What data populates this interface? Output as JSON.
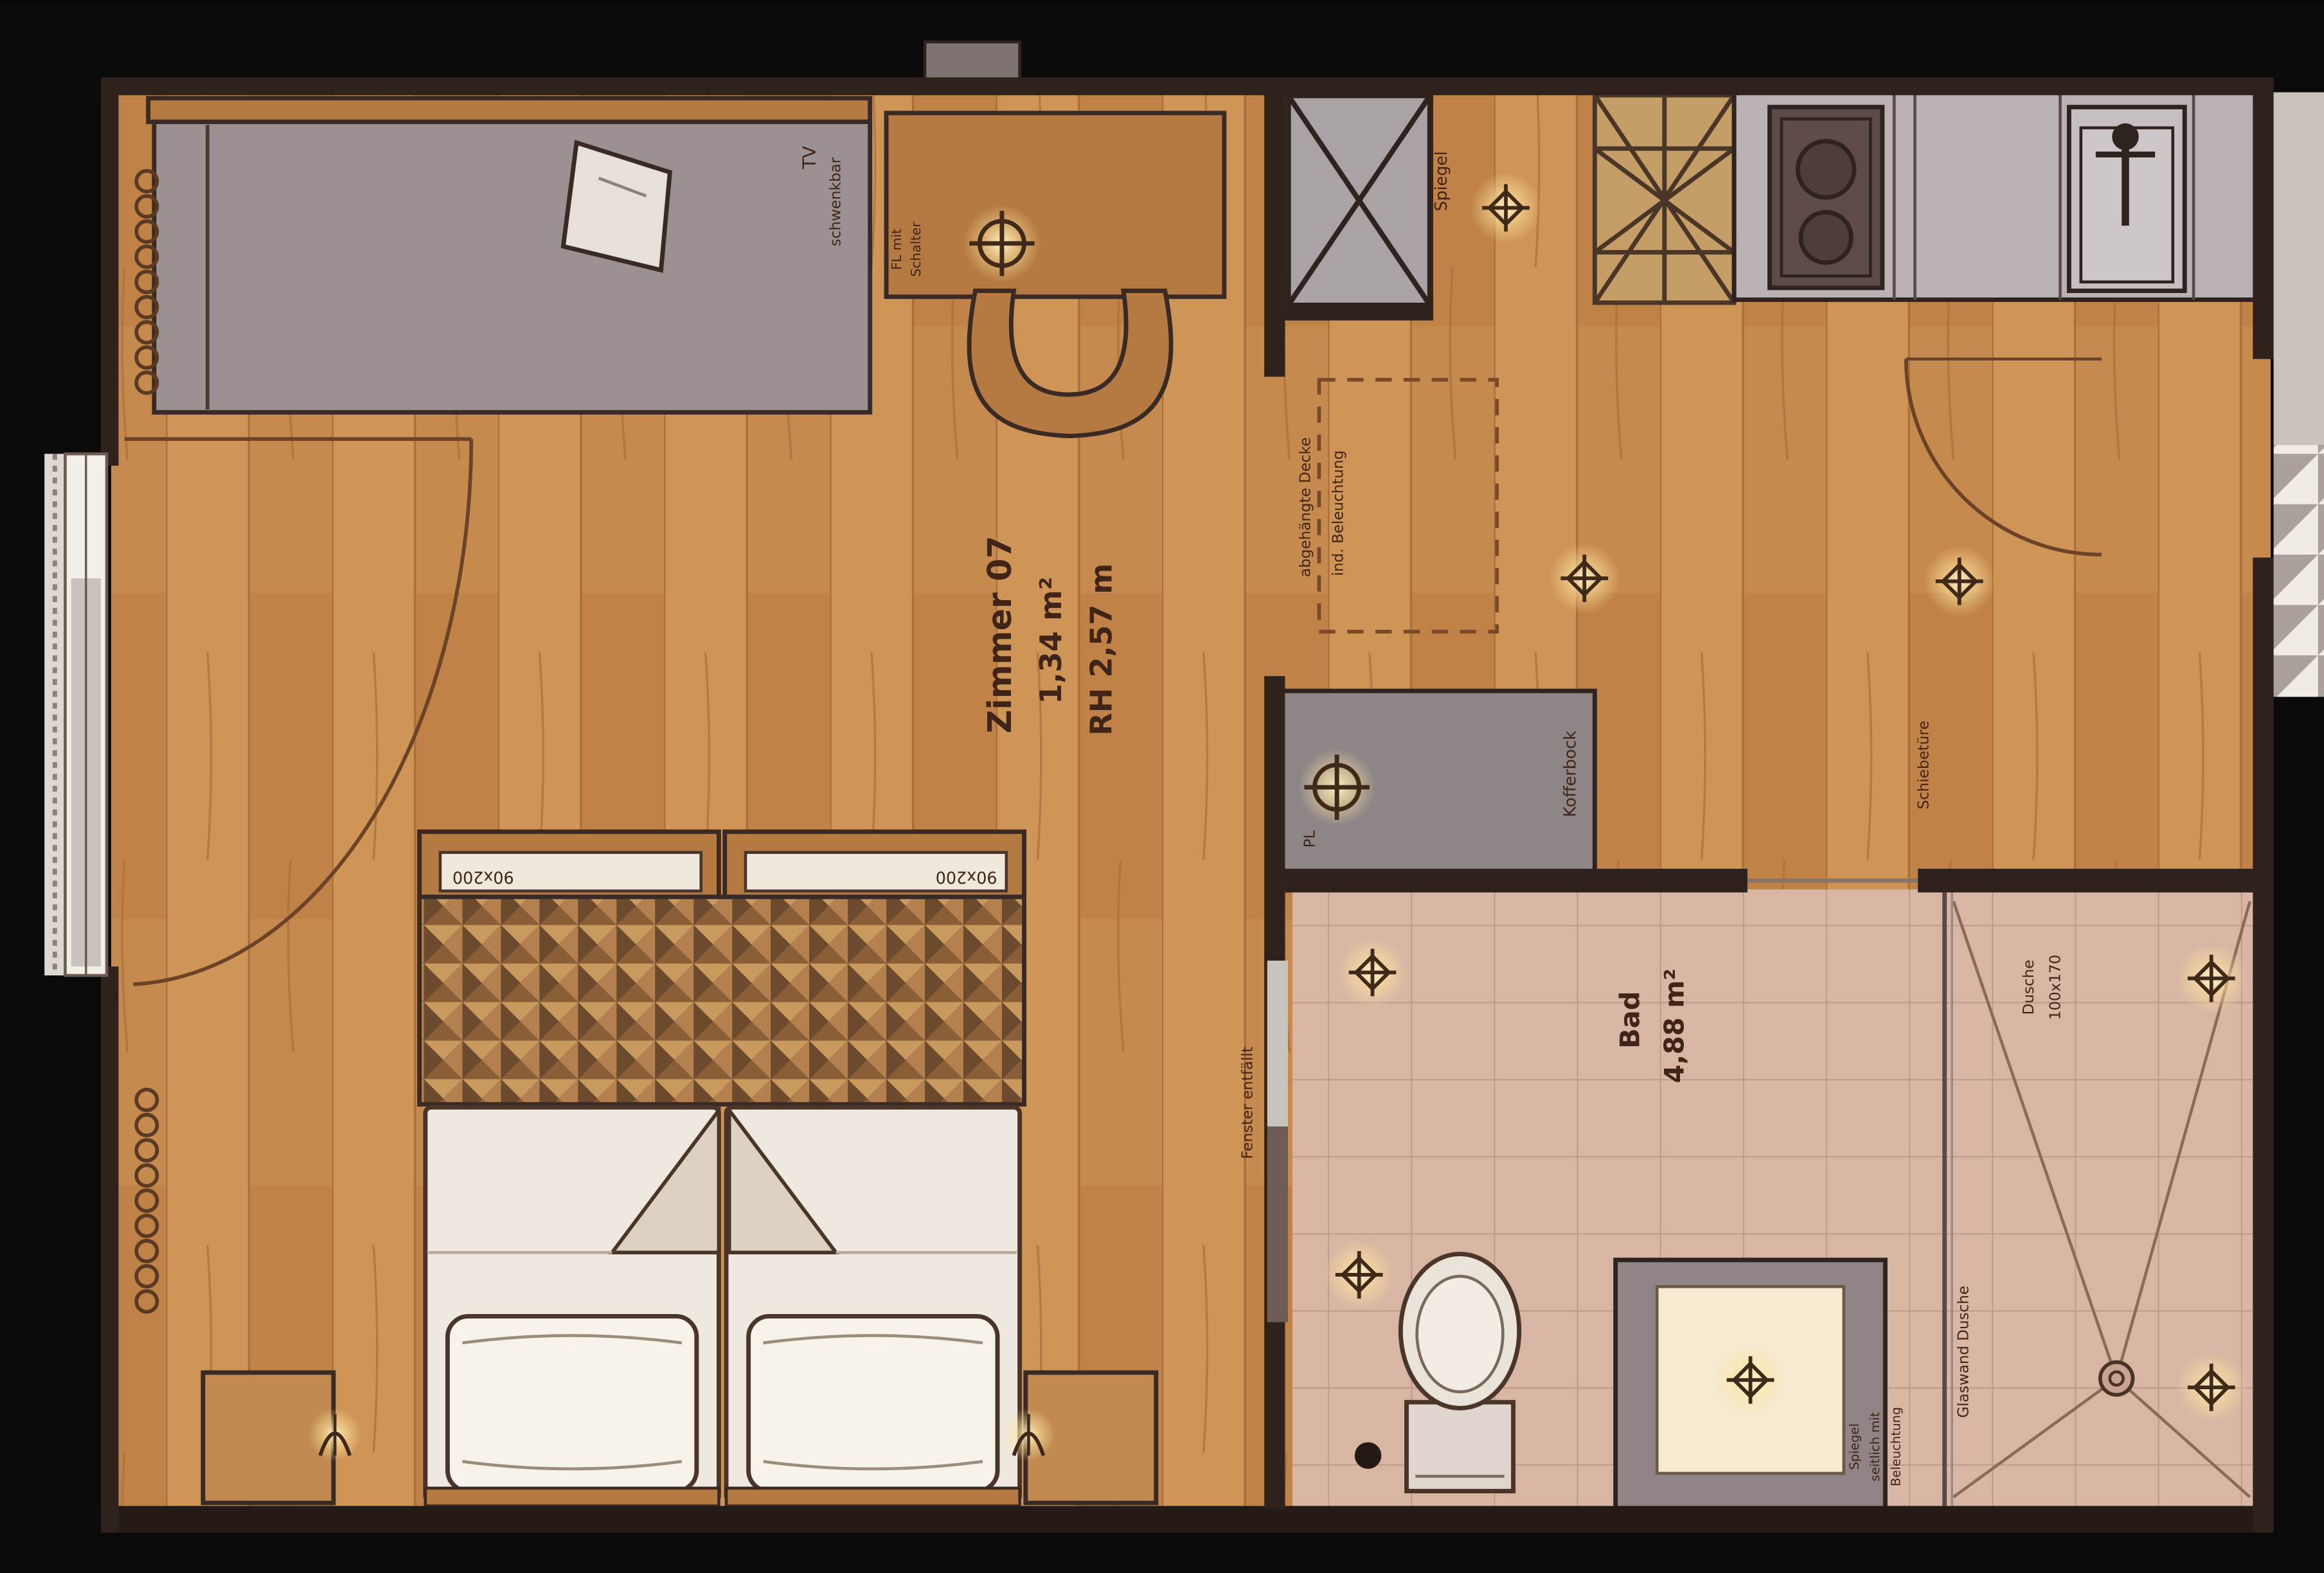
{
  "plan": {
    "room": {
      "name": "Zimmer 07",
      "area": "1,34 m²",
      "height": "RH 2,57 m"
    },
    "bath": {
      "name": "Bad",
      "area": "4,88 m²"
    },
    "labels": {
      "tv1": "TV",
      "tv2": "schwenkbar",
      "desk_light1": "FL mit",
      "desk_light2": "Schalter",
      "mirror": "Spiegel",
      "ceiling1": "abgehängte Decke",
      "ceiling2": "ind. Beleuchtung",
      "luggage": "Kofferbock",
      "pl": "PL",
      "sliding_door": "Schiebetüre",
      "window_note": "Fenster entfällt",
      "bed_left": "90x200",
      "bed_right": "90x200",
      "shower1": "Dusche",
      "shower2": "100x170",
      "glass_wall": "Glaswand Dusche",
      "vanity1": "Spiegel",
      "vanity2": "seitlich mit",
      "vanity3": "Beleuchtung"
    },
    "colors": {
      "wood": "#c78a4e",
      "tile": "#d9b5a3",
      "wall": "#2f221d",
      "glow": "#ffe9ad",
      "counter_gray": "#b9b1b3",
      "sofa_gray": "#9b9193",
      "luggage_gray": "#8e8587",
      "mosaic_dark": "#4a3526"
    }
  }
}
